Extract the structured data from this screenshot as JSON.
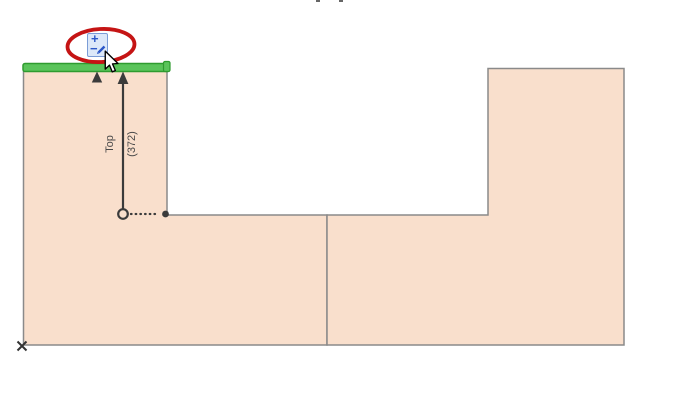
{
  "canvas": {
    "description": "CAD zone editing canvas",
    "dimension_label": {
      "name": "Top",
      "value": "(372)"
    }
  },
  "tracker_icon": {
    "semantic": "plus-minus-edit-icon",
    "plus_glyph": "+",
    "minus_glyph": "−"
  },
  "annotation": {
    "semantic": "red-ellipse-highlight"
  },
  "colors": {
    "zone_fill": "#f9dfcc",
    "zone_outline": "#8a8a8a",
    "selected_edge_fill": "#5ac45a",
    "selected_edge_outline": "#2f9b2f",
    "marker": "#3b3b3b",
    "highlight_ellipse": "#c51414",
    "icon_background": "#dce8f9",
    "icon_border": "#7b9cd6",
    "icon_glyph": "#2b57c8"
  }
}
